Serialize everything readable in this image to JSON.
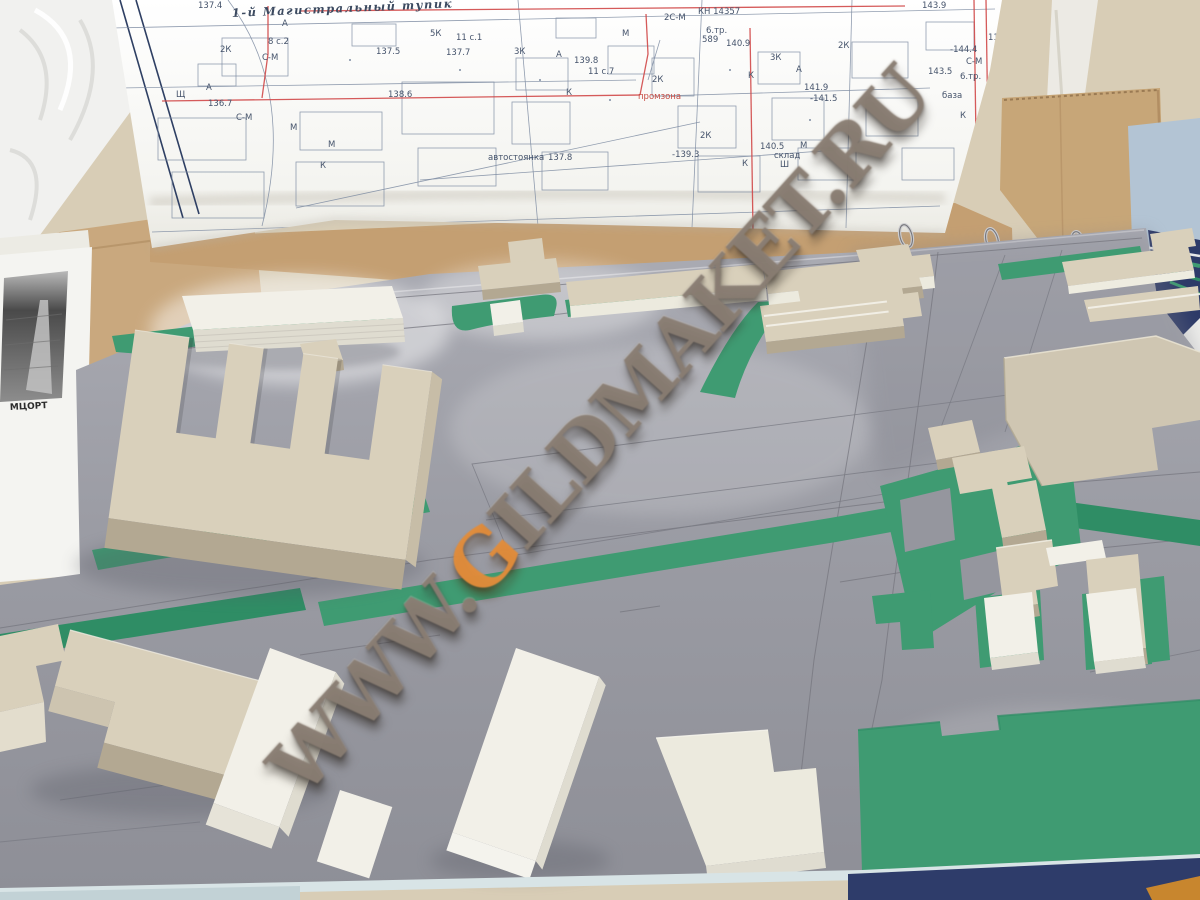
{
  "scene": {
    "type": "photograph",
    "subject": "architectural scale model (maket) of a city district on a table with a printed cadastral map sheet"
  },
  "watermark": {
    "prefix": "WWW.",
    "g": "G",
    "suffix": "ILDMAKET.RU",
    "full_text": "WWW.GILDMAKET.RU",
    "gray": "#8a7e73",
    "accent_orange": "#e28c3a"
  },
  "map": {
    "street_title": "1-й Магистральный тупик",
    "frame_color": "#2e3f63",
    "line_color": "#7e8ca2",
    "red_color": "#d04848",
    "labels": [
      {
        "t": "137.4",
        "x": 198,
        "y": 8
      },
      {
        "t": "2К",
        "x": 220,
        "y": 52
      },
      {
        "t": "А",
        "x": 282,
        "y": 26
      },
      {
        "t": "8 с.2",
        "x": 268,
        "y": 44
      },
      {
        "t": "С-М",
        "x": 262,
        "y": 60
      },
      {
        "t": "А",
        "x": 206,
        "y": 90
      },
      {
        "t": "Щ",
        "x": 176,
        "y": 97
      },
      {
        "t": "136.7",
        "x": 208,
        "y": 106
      },
      {
        "t": "С-М",
        "x": 236,
        "y": 120
      },
      {
        "t": "М",
        "x": 290,
        "y": 130
      },
      {
        "t": "М",
        "x": 328,
        "y": 147
      },
      {
        "t": "К",
        "x": 320,
        "y": 168
      },
      {
        "t": "137.5",
        "x": 376,
        "y": 54
      },
      {
        "t": "138.6",
        "x": 388,
        "y": 97
      },
      {
        "t": "5К",
        "x": 430,
        "y": 36
      },
      {
        "t": "11 с.1",
        "x": 456,
        "y": 40
      },
      {
        "t": "137.7",
        "x": 446,
        "y": 55
      },
      {
        "t": "3К",
        "x": 514,
        "y": 54
      },
      {
        "t": "А",
        "x": 556,
        "y": 57
      },
      {
        "t": "139.8",
        "x": 574,
        "y": 63
      },
      {
        "t": "11 с.7",
        "x": 588,
        "y": 74
      },
      {
        "t": "К",
        "x": 566,
        "y": 95
      },
      {
        "t": "М",
        "x": 622,
        "y": 36
      },
      {
        "t": "2К",
        "x": 652,
        "y": 82
      },
      {
        "t": "промзона",
        "x": 638,
        "y": 99,
        "r": 1
      },
      {
        "t": "2С-М",
        "x": 664,
        "y": 20
      },
      {
        "t": "КН 14357",
        "x": 698,
        "y": 14
      },
      {
        "t": "6.тр.",
        "x": 706,
        "y": 33
      },
      {
        "t": "589",
        "x": 702,
        "y": 42
      },
      {
        "t": "140.9",
        "x": 726,
        "y": 46
      },
      {
        "t": "3К",
        "x": 770,
        "y": 60
      },
      {
        "t": "К",
        "x": 748,
        "y": 78
      },
      {
        "t": "А",
        "x": 796,
        "y": 72
      },
      {
        "t": "141.9",
        "x": 804,
        "y": 90
      },
      {
        "t": "-141.5",
        "x": 810,
        "y": 101
      },
      {
        "t": "2К",
        "x": 838,
        "y": 48
      },
      {
        "t": "2К",
        "x": 700,
        "y": 138
      },
      {
        "t": "автостоянка",
        "x": 488,
        "y": 160
      },
      {
        "t": "137.8",
        "x": 548,
        "y": 160
      },
      {
        "t": "-139.3",
        "x": 672,
        "y": 157
      },
      {
        "t": "140.5",
        "x": 760,
        "y": 149
      },
      {
        "t": "М",
        "x": 800,
        "y": 148
      },
      {
        "t": "склад",
        "x": 774,
        "y": 158
      },
      {
        "t": "Ш",
        "x": 780,
        "y": 167
      },
      {
        "t": "К",
        "x": 742,
        "y": 166
      },
      {
        "t": "143.9",
        "x": 922,
        "y": 8
      },
      {
        "t": "-144.4",
        "x": 950,
        "y": 52
      },
      {
        "t": "С-М",
        "x": 966,
        "y": 64
      },
      {
        "t": "143.5",
        "x": 928,
        "y": 74
      },
      {
        "t": "6.тр.",
        "x": 960,
        "y": 79
      },
      {
        "t": "база",
        "x": 942,
        "y": 98
      },
      {
        "t": "К",
        "x": 960,
        "y": 118
      },
      {
        "t": "11 с.1",
        "x": 988,
        "y": 40
      }
    ]
  },
  "photo": {
    "caption": "МЦОРТ"
  },
  "colors": {
    "wall": "#d8cdb6",
    "cardboard": "#c7a277",
    "map_paper": "#f7f7f4",
    "model_base_gray": "#9b9ca4",
    "lawn_green": "#3f9b72",
    "building_cardboard": "#d9d0bb",
    "building_white": "#f2f0e8",
    "binder_navy": "#2d3a68",
    "paper_light_blue": "#b3c4d4",
    "table_orange": "#c8862e",
    "edge_strip": "#d8e4e6",
    "ring_metal": "#cfcfd2"
  }
}
